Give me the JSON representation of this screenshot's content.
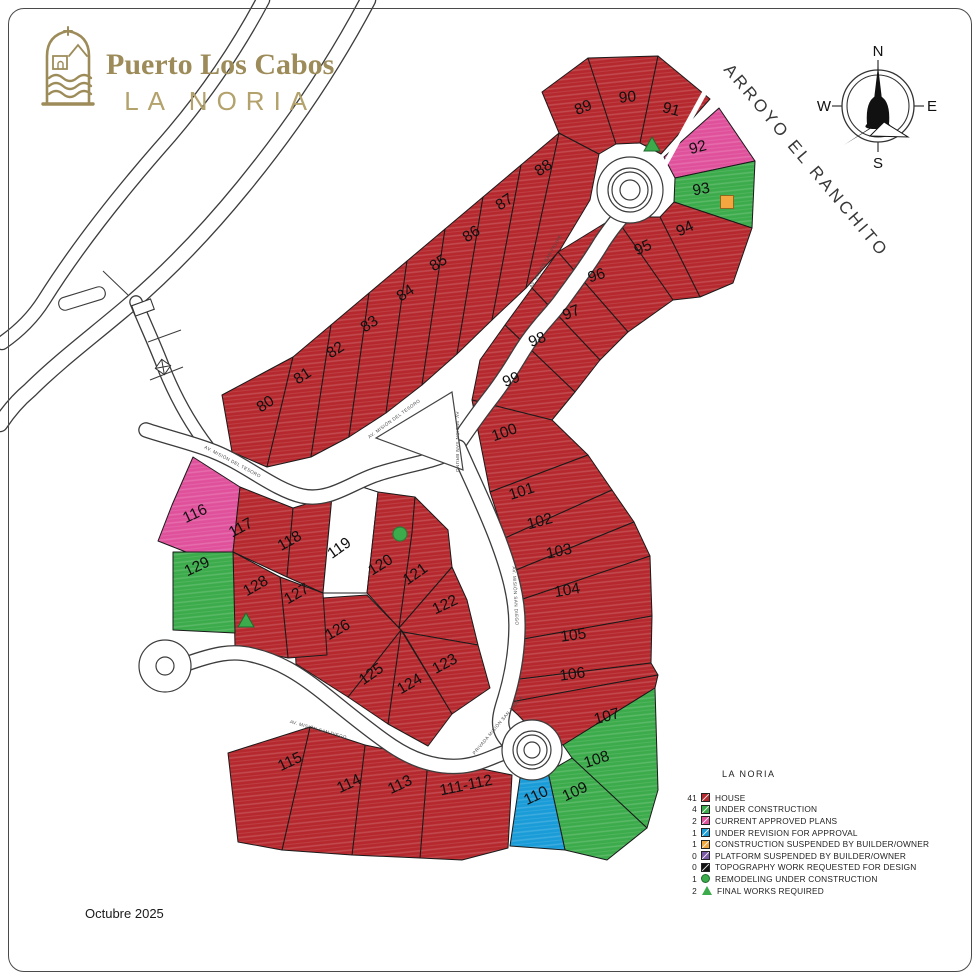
{
  "logo": {
    "title": "Puerto Los Cabos",
    "subtitle": "LA NORIA",
    "color": "#9d8c59"
  },
  "compass": {
    "n": "N",
    "s": "S",
    "e": "E",
    "w": "W"
  },
  "footer": {
    "date": "Octubre 2025"
  },
  "legend": {
    "title": "LA NORIA",
    "items": [
      {
        "count": "41",
        "type": "square",
        "color": "#b5292e",
        "label": "HOUSE"
      },
      {
        "count": "4",
        "type": "square",
        "color": "#3cab4b",
        "label": "UNDER CONSTRUCTION"
      },
      {
        "count": "2",
        "type": "square",
        "color": "#e0519c",
        "label": "CURRENT APPROVED PLANS"
      },
      {
        "count": "1",
        "type": "square",
        "color": "#1a9cd8",
        "label": "UNDER REVISION FOR APPROVAL"
      },
      {
        "count": "1",
        "type": "square",
        "color": "#f4a63f",
        "label": "CONSTRUCTION SUSPENDED BY BUILDER/OWNER"
      },
      {
        "count": "0",
        "type": "square",
        "color": "#7c59a4",
        "label": "PLATFORM SUSPENDED BY BUILDER/OWNER"
      },
      {
        "count": "0",
        "type": "square",
        "color": "#111111",
        "label": "TOPOGRAPHY WORK REQUESTED FOR DESIGN"
      },
      {
        "count": "1",
        "type": "circle",
        "color": "#3cab4b",
        "label": "REMODELING UNDER CONSTRUCTION"
      },
      {
        "count": "2",
        "type": "triangle",
        "color": "#3cab4b",
        "label": "FINAL WORKS REQUIRED"
      }
    ]
  },
  "status_colors": {
    "h": "#b5292e",
    "c": "#3cab4b",
    "a": "#e0519c",
    "r": "#1a9cd8"
  },
  "map": {
    "arroyo_label": "ARROYO EL RANCHITO",
    "arroyo_pos": {
      "x": 802,
      "y": 164,
      "r": 50
    },
    "lots": [
      {
        "n": "80",
        "s": "h",
        "p": "222,395 293,357 267,467 232,452",
        "x": 268,
        "y": 408,
        "r": -33
      },
      {
        "n": "81",
        "s": "h",
        "p": "293,357 331,325 311,457 267,467",
        "x": 305,
        "y": 380,
        "r": -33
      },
      {
        "n": "82",
        "s": "h",
        "p": "331,325 369,293 349,437 311,457",
        "x": 338,
        "y": 354,
        "r": -33
      },
      {
        "n": "83",
        "s": "h",
        "p": "369,293 407,261 386,413 349,437",
        "x": 372,
        "y": 328,
        "r": -33
      },
      {
        "n": "84",
        "s": "h",
        "p": "407,261 445,229 422,385 386,413",
        "x": 408,
        "y": 297,
        "r": -33
      },
      {
        "n": "85",
        "s": "h",
        "p": "445,229 483,197 457,354 422,385",
        "x": 441,
        "y": 267,
        "r": -33
      },
      {
        "n": "86",
        "s": "h",
        "p": "483,197 521,165 492,320 457,354",
        "x": 474,
        "y": 238,
        "r": -33
      },
      {
        "n": "87",
        "s": "h",
        "p": "521,165 559,133 526,288 492,320",
        "x": 507,
        "y": 206,
        "r": -33
      },
      {
        "n": "88",
        "s": "h",
        "p": "559,133 599,154 590,200 560,250 526,288",
        "x": 546,
        "y": 172,
        "r": -33
      },
      {
        "n": "89",
        "s": "h",
        "p": "542,92 588,58 616,144 599,154 559,133",
        "x": 585,
        "y": 112,
        "r": -22
      },
      {
        "n": "90",
        "s": "h",
        "p": "588,58 658,56 640,143 616,144",
        "x": 628,
        "y": 102,
        "r": -6
      },
      {
        "n": "91",
        "s": "h",
        "p": "658,56 710,99 661,154 640,143",
        "x": 670,
        "y": 114,
        "r": 15
      },
      {
        "n": "92",
        "s": "a",
        "p": "664,157 719,108 755,161 675,178",
        "x": 699,
        "y": 152,
        "r": -15
      },
      {
        "n": "93",
        "s": "c",
        "p": "675,178 755,161 752,228 674,202",
        "x": 702,
        "y": 194,
        "r": -10
      },
      {
        "n": "94",
        "s": "h",
        "p": "660,217 674,202 752,228 733,283 700,297",
        "x": 687,
        "y": 233,
        "r": -25
      },
      {
        "n": "95",
        "s": "h",
        "p": "615,217 660,217 700,297 673,300",
        "x": 645,
        "y": 252,
        "r": -25
      },
      {
        "n": "96",
        "s": "h",
        "p": "558,252 615,217 673,300 628,332",
        "x": 598,
        "y": 280,
        "r": -18
      },
      {
        "n": "97",
        "s": "h",
        "p": "532,288 558,252 628,332 600,360",
        "x": 573,
        "y": 317,
        "r": -22
      },
      {
        "n": "98",
        "s": "h",
        "p": "505,325 532,288 600,360 575,392",
        "x": 539,
        "y": 344,
        "r": -22
      },
      {
        "n": "99",
        "s": "h",
        "p": "472,400 480,360 505,325 575,392 552,420",
        "x": 513,
        "y": 384,
        "r": -22
      },
      {
        "n": "100",
        "s": "h",
        "p": "472,400 552,420 588,455 490,492",
        "x": 506,
        "y": 437,
        "r": -20
      },
      {
        "n": "101",
        "s": "h",
        "p": "490,492 588,455 612,490 505,538",
        "x": 523,
        "y": 496,
        "r": -18
      },
      {
        "n": "102",
        "s": "h",
        "p": "505,538 612,490 634,522 516,570",
        "x": 541,
        "y": 526,
        "r": -15
      },
      {
        "n": "103",
        "s": "h",
        "p": "516,570 634,522 650,556 520,600",
        "x": 560,
        "y": 556,
        "r": -12
      },
      {
        "n": "104",
        "s": "h",
        "p": "520,600 650,556 652,616 518,640",
        "x": 568,
        "y": 595,
        "r": -10
      },
      {
        "n": "105",
        "s": "h",
        "p": "518,640 652,616 651,663 512,680",
        "x": 574,
        "y": 640,
        "r": -8
      },
      {
        "n": "106",
        "s": "h",
        "p": "512,680 651,663 658,675 505,703",
        "x": 573,
        "y": 679,
        "r": -8
      },
      {
        "n": "107",
        "s": "h",
        "p": "505,703 658,675 655,688 563,745 540,738 518,715",
        "x": 608,
        "y": 721,
        "r": -15
      },
      {
        "n": "108",
        "s": "c",
        "p": "563,745 655,688 658,790 647,828 572,758",
        "x": 598,
        "y": 764,
        "r": -18
      },
      {
        "n": "109",
        "s": "c",
        "p": "548,772 572,758 647,828 607,860 565,850",
        "x": 577,
        "y": 796,
        "r": -25
      },
      {
        "n": "110",
        "s": "r",
        "p": "520,778 548,772 565,850 510,846",
        "x": 538,
        "y": 800,
        "r": -25
      },
      {
        "n": "111-112",
        "s": "h",
        "p": "428,758 512,775 508,848 462,860 420,858",
        "x": 467,
        "y": 790,
        "r": -12
      },
      {
        "n": "113",
        "s": "h",
        "p": "365,745 428,758 420,858 352,855",
        "x": 402,
        "y": 789,
        "r": -25
      },
      {
        "n": "114",
        "s": "h",
        "p": "310,727 365,745 352,855 282,850",
        "x": 351,
        "y": 788,
        "r": -25
      },
      {
        "n": "115",
        "s": "h",
        "p": "228,753 310,727 282,850 238,842",
        "x": 292,
        "y": 766,
        "r": -25
      },
      {
        "n": "116",
        "s": "a",
        "p": "193,457 240,487 233,552 186,552 158,541 172,505",
        "x": 197,
        "y": 518,
        "r": -25
      },
      {
        "n": "117",
        "s": "h",
        "p": "240,487 293,508 287,577 233,552",
        "x": 243,
        "y": 532,
        "r": -28
      },
      {
        "n": "118",
        "s": "h",
        "p": "293,508 332,496 323,593 287,577",
        "x": 292,
        "y": 545,
        "r": -30
      },
      {
        "n": "119",
        "s": "w",
        "p": "332,496 356,485 378,492 367,593 323,593",
        "x": 342,
        "y": 552,
        "r": -35
      },
      {
        "n": "120",
        "s": "h",
        "p": "378,492 415,497 412,533 399,628 367,593",
        "x": 383,
        "y": 569,
        "r": -32
      },
      {
        "n": "121",
        "s": "h",
        "p": "412,533 415,497 448,530 452,567 399,628",
        "x": 418,
        "y": 578,
        "r": -35
      },
      {
        "n": "122",
        "s": "h",
        "p": "399,628 452,567 467,600 478,645 403,632",
        "x": 447,
        "y": 609,
        "r": -25
      },
      {
        "n": "123",
        "s": "h",
        "p": "403,632 478,645 490,688 452,714",
        "x": 447,
        "y": 668,
        "r": -28
      },
      {
        "n": "124",
        "s": "h",
        "p": "401,630 452,714 428,746 388,724",
        "x": 412,
        "y": 688,
        "r": -30
      },
      {
        "n": "125",
        "s": "h",
        "p": "401,630 388,724 348,697",
        "x": 374,
        "y": 678,
        "r": -35
      },
      {
        "n": "126",
        "s": "h",
        "p": "401,630 348,697 296,664 293,600 367,595",
        "x": 340,
        "y": 634,
        "r": -30
      },
      {
        "n": "127",
        "s": "h",
        "p": "280,577 323,593 327,655 288,658",
        "x": 299,
        "y": 598,
        "r": -30
      },
      {
        "n": "128",
        "s": "h",
        "p": "233,552 280,577 288,658 235,647",
        "x": 258,
        "y": 590,
        "r": -30
      },
      {
        "n": "129",
        "s": "c",
        "p": "173,552 233,552 235,633 173,630",
        "x": 199,
        "y": 571,
        "r": -25
      }
    ],
    "markers": [
      {
        "type": "triangle",
        "x": 652,
        "y": 146
      },
      {
        "type": "triangle",
        "x": 246,
        "y": 622
      },
      {
        "type": "circle",
        "x": 400,
        "y": 534
      },
      {
        "type": "square",
        "x": 727,
        "y": 202
      }
    ],
    "roads": [
      {
        "d": "M263,0 C230,62 192,112 158,150 C118,196 78,246 44,300 C32,319 18,332 2,343",
        "w": 12
      },
      {
        "d": "M368,0 C330,72 288,132 243,187 C203,236 163,276 128,306 C94,335 58,362 30,390 C18,400 8,412 0,424",
        "w": 14
      },
      {
        "d": "M136,302 C146,326 155,345 163,366 C172,389 186,418 208,447",
        "w": 11
      },
      {
        "d": "M146,430 C170,438 196,444 215,452 C245,464 275,490 302,496 C330,502 352,482 378,474 C406,465 432,462 452,452",
        "w": 13
      },
      {
        "d": "M452,452 C468,428 478,414 492,396 C512,370 518,356 528,342 C542,322 552,314 562,300 C578,278 590,262 602,242 C612,227 618,220 627,210",
        "w": 15
      },
      {
        "d": "M458,448 C472,480 486,508 498,540 C510,572 517,598 517,625 C517,655 512,678 506,698 C500,717 497,728 508,740",
        "w": 15
      },
      {
        "d": "M186,664 C214,654 232,650 252,655 C278,661 298,673 322,692 C346,711 368,730 392,746 C416,762 440,768 462,766 C480,764 492,757 506,752",
        "w": 13
      }
    ],
    "island": "376,438 452,392 463,470",
    "sliver": {
      "x1": 706,
      "y1": 90,
      "x2": 662,
      "y2": 170
    },
    "roundabouts": [
      {
        "x": 630,
        "y": 190,
        "rings": [
          33,
          22,
          18,
          10
        ]
      },
      {
        "x": 532,
        "y": 750,
        "rings": [
          30,
          19,
          15,
          8
        ]
      },
      {
        "x": 165,
        "y": 666,
        "rings": [
          26,
          9
        ]
      }
    ],
    "entrance": {
      "ticks": [
        "103,271 128,295",
        "148,342 181,330",
        "150,380 183,367"
      ],
      "gate": {
        "x": 163,
        "y": 367,
        "s": 11,
        "r": 35
      },
      "building": {
        "x": 133,
        "y": 302,
        "w": 20,
        "h": 11,
        "r": -20
      },
      "ramp": {
        "x": 58,
        "y": 292,
        "w": 48,
        "h": 13,
        "r": -17
      }
    },
    "streets": [
      {
        "t": "AV. MISIÓN DEL TESORO",
        "x": 232,
        "y": 463,
        "r": 28
      },
      {
        "t": "AV. MISIÓN DEL TESORO",
        "x": 395,
        "y": 420,
        "r": -36
      },
      {
        "t": "AV. MISIÓN SAN FELIPE",
        "x": 547,
        "y": 262,
        "r": -60
      },
      {
        "t": "AV. MISIÓN SAN BRUNO",
        "x": 456,
        "y": 442,
        "r": 90
      },
      {
        "t": "AV. MISIÓN SAN DIEGO",
        "x": 514,
        "y": 596,
        "r": 87
      },
      {
        "t": "AV. MISIÓN SAN DIEGO",
        "x": 318,
        "y": 731,
        "r": 16
      },
      {
        "t": "PRIVADA MISIÓN SAN JOSÉ A",
        "x": 499,
        "y": 726,
        "r": -50
      }
    ]
  }
}
